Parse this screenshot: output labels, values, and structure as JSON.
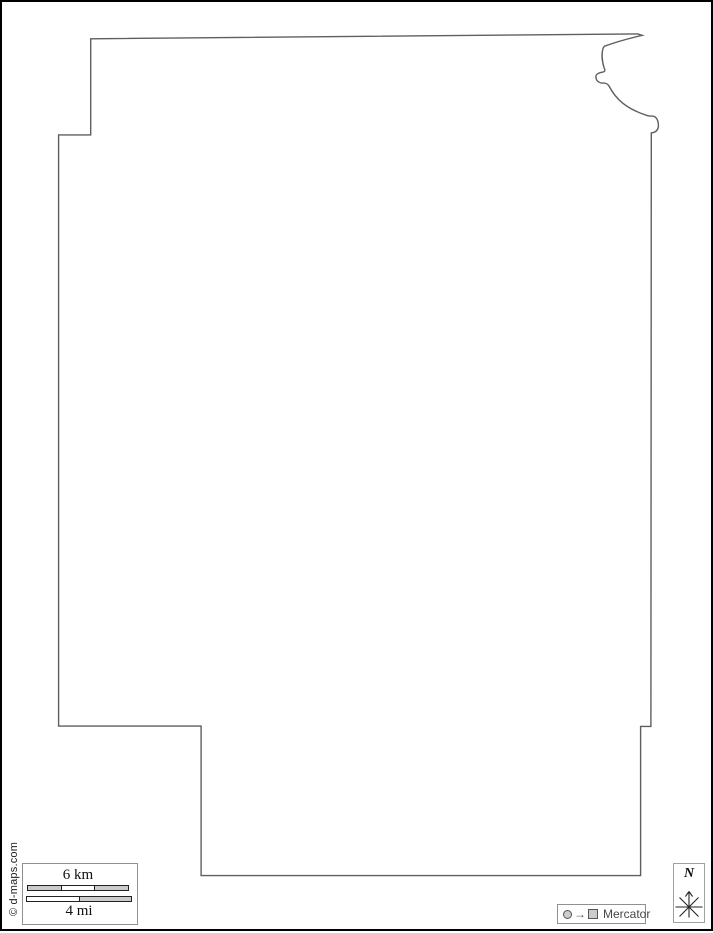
{
  "page": {
    "background": "#ffffff",
    "frame_color": "#000000"
  },
  "map": {
    "description": "blank administrative area outline map",
    "outline_color": "#5f5f5f",
    "fill": "#ffffff",
    "outline_path": "M 90.7 38.8 L 637.6 33.9 L 642.2 35.3 Q 620 40.5 604.5 46.2 L 603.2 47.8 C 601.6 52.5 601.7 60 604 67.5 C 605.3 70.2 605.2 71.6 602.8 72.1 C 598.8 72.9 595.7 73.8 595.9 77.2 C 596.1 80.7 598.9 83.2 603.4 83.1 C 606.4 83 608 84 609.6 87 C 612.2 92 616 97.5 622.3 102.8 C 629.2 108.4 638.2 112.7 647.6 115.7 C 650.6 116.6 653.1 115.3 655.1 116.9 C 657.4 118.7 658.4 121.6 658.4 125.4 C 658.4 129.4 656.5 132.4 651.3 132.9 L 650.9 726.4 L 640.6 726.4 L 640.6 875.6 L 201.1 875.6 L 201.1 726.1 L 58.6 726.1 L 58.6 134.9 L 90.7 134.9 Z"
  },
  "scale_bar": {
    "km_label": "6 km",
    "mi_label": "4 mi",
    "km_segment_count": 3,
    "mi_segment_count": 2,
    "segment_gray": "#cbcbcb",
    "segment_white": "#ffffff",
    "box_border": "#909090"
  },
  "projection_badge": {
    "circle_icon": "sphere-circle-icon",
    "arrow": "→",
    "square_icon": "flat-map-square-icon",
    "label": "Mercator"
  },
  "compass": {
    "north_label": "N"
  },
  "credit": {
    "text": "© d-maps.com"
  }
}
